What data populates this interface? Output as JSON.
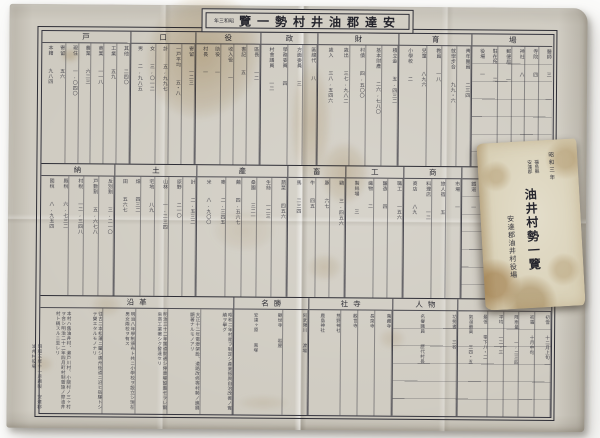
{
  "scene": {
    "background_color": "#fbfbfa",
    "paper_color": "#cfcbc1",
    "booklet_color": "#dad2b9",
    "ink_color": "#2e2e36",
    "stain_color": "#ac843e"
  },
  "sheet": {
    "title_box": {
      "era_display": "年三和昭",
      "title_display": "覽一勢村井油郡達安",
      "reading": "安達郡油井村勢一覽 昭和三年"
    },
    "colophon": "昭和三年十一月調製 安達郡油井村役場",
    "table": {
      "bands": [
        {
          "name": "band-1",
          "sections": [
            {
              "label": "戸",
              "flex": 1.1,
              "cols": [
                "本籍  九八四",
                "寄留  五六",
                "現住  一,〇四〇",
                "農業  六二三",
                "商業  一一八",
                "工業  五九",
                "其他  二四〇"
              ]
            },
            {
              "label": "口",
              "flex": 0.8,
              "cols": [
                "男  二,九八五",
                "女  三,〇一二",
                "計  五,九九七",
                "一戸平均  五・八",
                "寄留  一二三"
              ]
            },
            {
              "label": "役",
              "flex": 0.8,
              "cols": [
                "村長  一",
                "助役  一",
                "收入役  一",
                "書記  五",
                "區長  一二"
              ]
            },
            {
              "label": "政",
              "flex": 0.7,
              "cols": [
                "村會議員  一二",
                "學務委員  四",
                "方面委員  三",
                "區總代  八"
              ]
            },
            {
              "label": "財",
              "flex": 1.0,
              "cols": [
                "歲入  三八,五四六",
                "歲出  三七,九八二",
                "村債  四,五〇〇",
                "基本財產  二六,七八〇",
                "積立金  五,四三二"
              ]
            },
            {
              "label": "育",
              "flex": 0.9,
              "cols": [
                "小學校  二",
                "兒童  八九六",
                "教員  一八",
                "就學步合  九九・六",
                "靑年團員  二三四"
              ]
            },
            {
              "label": "場",
              "flex": 1.0,
              "rows": true,
              "cols": [
                "役場  一",
                "駐在所  二",
                "郵便局  一",
                "神社  八",
                "寺院  四",
                "醫師  三"
              ]
            }
          ]
        },
        {
          "name": "band-2",
          "sections": [
            {
              "label": "納",
              "flex": 0.9,
              "cols": [
                "國稅  八,九五四",
                "縣稅  六,七三二",
                "村稅  一二,三四八",
                "戸數割  五,六七八",
                "反別割  三,二一〇"
              ]
            },
            {
              "label": "土",
              "flex": 1.0,
              "cols": [
                "田  五六七",
                "畑  四三二",
                "宅地  八九",
                "山林  一,二三四",
                "原野  二一〇",
                "計  二,五三二"
              ]
            },
            {
              "label": "產",
              "flex": 1.1,
              "cols": [
                "米  八,九〇〇",
                "麥  二,三四五",
                "繭  四,五六七",
                "桑園  三二一",
                "生絲  一二三",
                "蔬菜  四五六"
              ]
            },
            {
              "label": "畜",
              "flex": 0.7,
              "cols": [
                "馬  二三四",
                "牛  四五",
                "豚  六七",
                "鷄  三,四五六"
              ]
            },
            {
              "label": "工",
              "flex": 0.7,
              "cols": [
                "製絲場  三",
                "織物  二",
                "釀造  四",
                "職工  一五六"
              ]
            },
            {
              "label": "商",
              "flex": 0.7,
              "cols": [
                "商店  八九",
                "料理店  一二",
                "旅人宿  五",
                "市場  一"
              ]
            },
            {
              "label": "交",
              "flex": 1.1,
              "rows": true,
              "cols": [
                "鐵道  一",
                "停車場  一",
                "道路里程  四・五",
                "橋梁  二三",
                "郵便物  六七,八九〇",
                "電話  三四"
              ]
            }
          ]
        },
        {
          "name": "band-3",
          "history": true,
          "sections": [
            {
              "label": "沿革",
              "flex": 2.1,
              "cols": [
                "本村ハ舊油井村、瀨戸川村、小關村ノ三ヶ村ヲ合シ明治二十二年四月町村制實施ノ際油井村ト稱スルニ至レリ",
                "往古二本松藩ニ屬シ奧州街道ニ沿ヒ宿驛トシテ榮エタルモノナリ",
                "明治八年學制頒布ト共ニ小學校ヲ設立シ現在男女兩校ヲ有ス",
                "明治三十二年鐵道開通シ停車場設置セラレ爾來商工業著シク發達セリ",
                "大正十二年電燈架設、道路改修等村勢ノ進展顯著ナルモノアリ",
                "昭和二年村是ヲ制定シ產業振興自治改善ノ實績ヲ擧グ"
              ]
            },
            {
              "label": "名勝",
              "flex": 0.8,
              "cols": [
                "安達ヶ原  黑塚",
                "觀世寺  岩屋",
                "阿武隈川  渡場"
              ]
            },
            {
              "label": "社寺",
              "flex": 0.9,
              "cols": [
                "鹿島神社",
                "熊野神社",
                "觀世寺",
                "長泉寺",
                "萬藏寺"
              ]
            },
            {
              "label": "人物",
              "flex": 0.7,
              "rows": true,
              "cols": [
                "名譽職員  歷代村長",
                "功勞者  三名"
              ]
            },
            {
              "label": "氣象",
              "flex": 1.0,
              "rows": true,
              "cols": [
                "氣温最高  三四・五",
                "最低  零下八・二",
                "平均  一二・三",
                "降雨量  一,二三四",
                "初霜  十月中旬",
                "初雪  十二月上旬"
              ]
            }
          ]
        }
      ]
    }
  },
  "booklet": {
    "era": "昭和三年",
    "region": [
      "福島縣",
      "安達郡"
    ],
    "title": "油井村勢一覽",
    "publisher": "安達郡油井村役場"
  }
}
